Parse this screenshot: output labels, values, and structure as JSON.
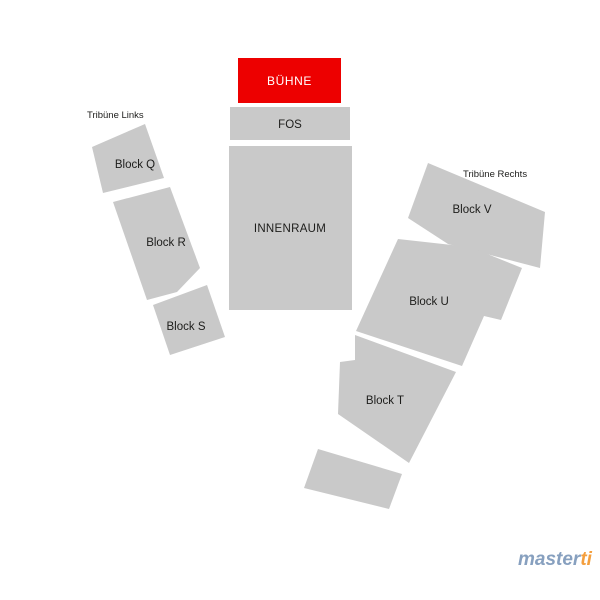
{
  "stage": {
    "label": "BÜHNE"
  },
  "floor": {
    "fos_label": "FOS",
    "innenraum_label": "INNENRAUM"
  },
  "tribune_left": {
    "label": "Tribüne Links",
    "blocks": [
      {
        "label": "Block Q"
      },
      {
        "label": "Block R"
      },
      {
        "label": "Block S"
      }
    ]
  },
  "tribune_right": {
    "label": "Tribüne Rechts",
    "blocks": [
      {
        "label": "Block V"
      },
      {
        "label": "Block U"
      },
      {
        "label": "Block T"
      }
    ]
  },
  "brand": {
    "part1": "master",
    "part2": "ti"
  },
  "colors": {
    "background": "#ffffff",
    "block_fill": "#c9c9c9",
    "stage_fill": "#ed0000",
    "stage_text": "#ffffff",
    "label_text": "#1d1d1b",
    "brand_blue": "#87a0bf",
    "brand_orange": "#f49f3e"
  }
}
